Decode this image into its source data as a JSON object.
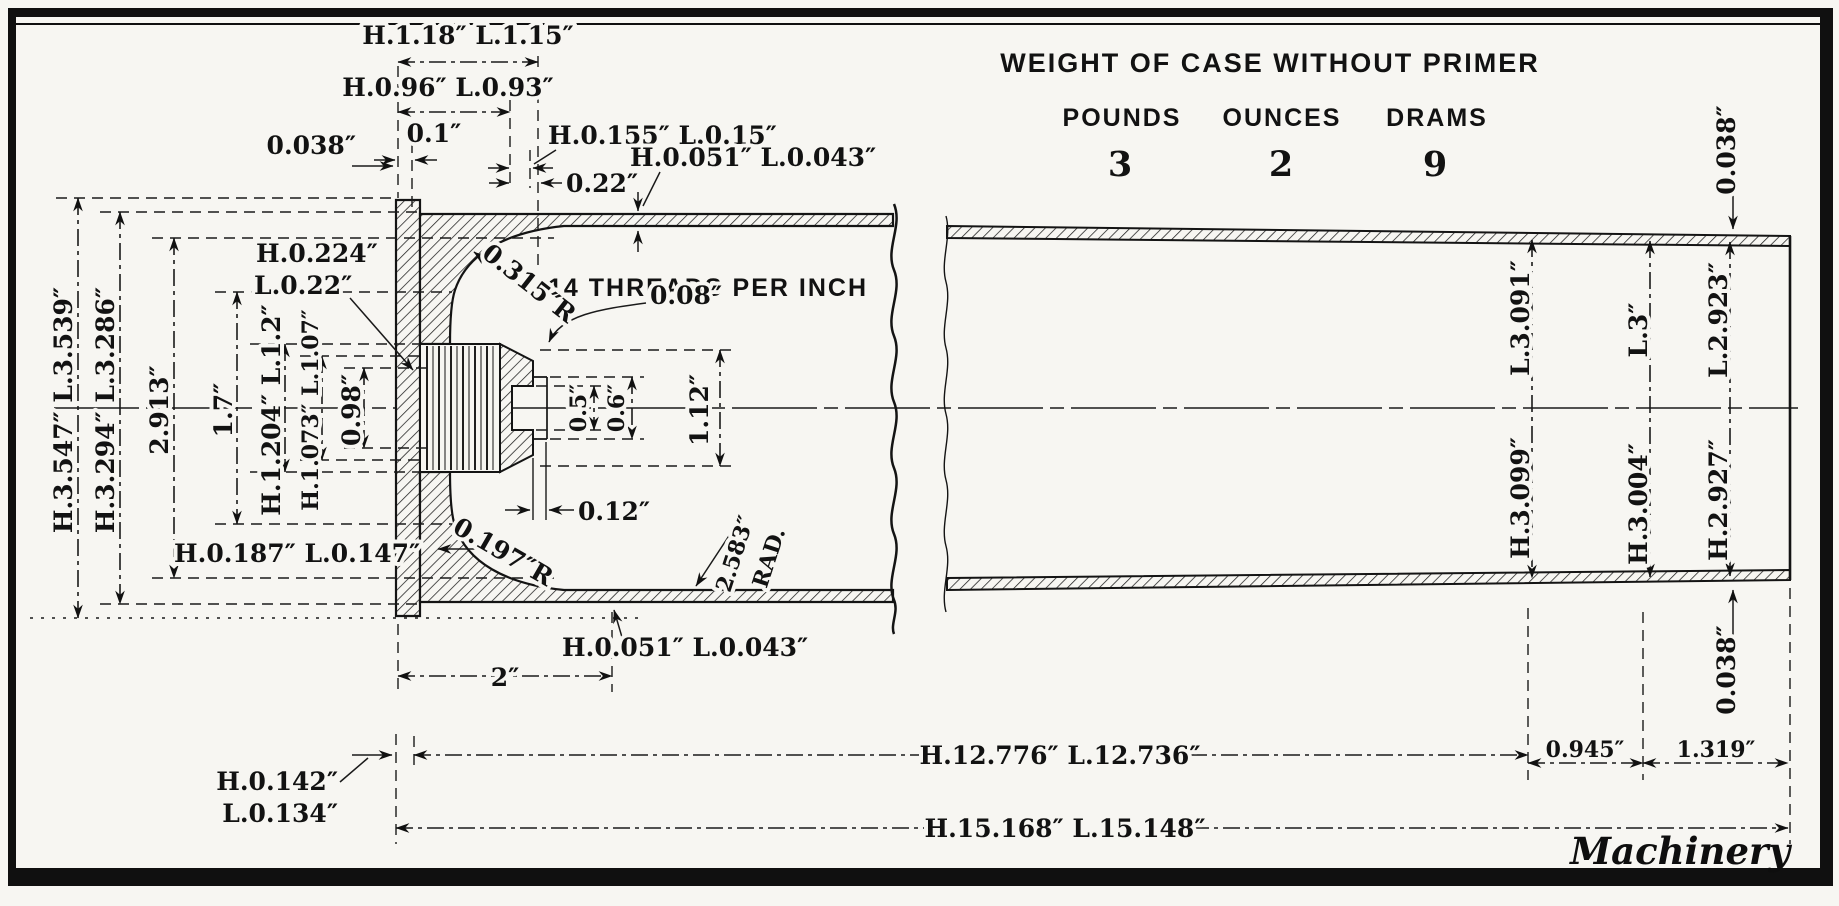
{
  "weight_table": {
    "title": "WEIGHT OF CASE WITHOUT PRIMER",
    "headers": [
      "POUNDS",
      "OUNCES",
      "DRAMS"
    ],
    "values": [
      "3",
      "2",
      "9"
    ]
  },
  "credit": "Machinery",
  "notes": {
    "threads": "14 THREADS PER INCH"
  },
  "dims": {
    "top": {
      "d1_18": "H.1.18″ L.1.15″",
      "d0_96": "H.0.96″ L.0.93″",
      "d0_1": "0.1″",
      "d0_038": "0.038″",
      "d0_155": "H.0.155″ L.0.15″",
      "d0_22": "0.22″",
      "wall_top": "H.0.051″ L.0.043″"
    },
    "head": {
      "d0_224a": "H.0.224″",
      "d0_224b": "L.0.22″",
      "r0_315": "0.315″R",
      "d0_08": "0.08″",
      "d0_5": "0.5″",
      "d0_6": "0.6″",
      "d1_12": "1.12″",
      "d0_12": "0.12″",
      "r0_197": "0.197″R",
      "rad2_583a": "2.583″",
      "rad2_583b": "RAD.",
      "wall_bottom": "H.0.051″ L.0.043″",
      "d0_187": "H.0.187″ L.0.147″"
    },
    "left": [
      "H.3.547″ L.3.539″",
      "H.3.294″ L.3.286″",
      "2.913″",
      "1.7″",
      "H.1.204″ L.1.2″",
      "H.1.073″ L.1.07″",
      "0.98″"
    ],
    "right": {
      "top0_038": "0.038″",
      "bot0_038": "0.038″",
      "dia1_h": "H.3.099″",
      "dia1_l": "L.3.091″",
      "dia2_h": "H.3.004″",
      "dia2_l": "L.3″",
      "dia3_h": "H.2.927″",
      "dia3_l": "L.2.923″"
    },
    "bottom": {
      "d2": "2″",
      "d0_142a": "H.0.142″",
      "d0_142b": "L.0.134″",
      "d12": "H.12.776″ L.12.736″",
      "d15": "H.15.168″ L.15.148″",
      "d0_945": "0.945″",
      "d1_319": "1.319″"
    }
  }
}
